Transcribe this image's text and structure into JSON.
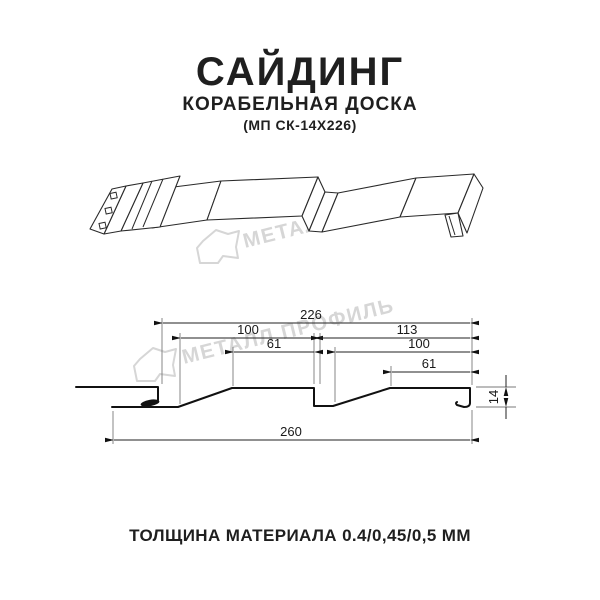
{
  "header": {
    "title": "САЙДИНГ",
    "subtitle": "КОРАБЕЛЬНАЯ ДОСКА",
    "model_code": "(МП СК-14Х226)"
  },
  "watermark": {
    "brand_text": "МЕТАЛЛ ПРОФИЛЬ",
    "color": "#d6d6d6"
  },
  "section_drawing": {
    "dimensions": {
      "overall_width_top": "226",
      "left_panel_width": "100",
      "right_panel_width": "113",
      "left_plateau_width": "61",
      "right_panel_inner_width": "100",
      "right_plateau_width": "61",
      "total_width_bottom": "260",
      "profile_height": "14"
    }
  },
  "footer": {
    "material_thickness": "ТОЛЩИНА МАТЕРИАЛА 0.4/0,45/0,5 ММ"
  },
  "colors": {
    "line": "#1a1a1a",
    "dim_text": "#1a1a1a",
    "watermark": "#d6d6d6",
    "background": "#ffffff"
  }
}
